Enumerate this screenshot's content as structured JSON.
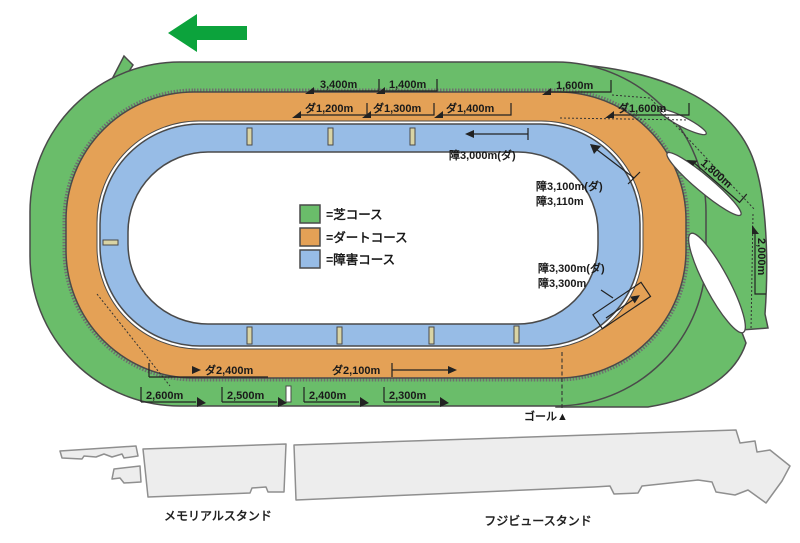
{
  "diagram": {
    "title": "racecourse-layout",
    "direction": "left",
    "colors": {
      "turf": "#6abd6a",
      "dirt": "#e4a156",
      "jump": "#97bce6",
      "direction_arrow": "#0ca33c",
      "stand_fill": "#ededed",
      "tick_fill": "#d9d4a5"
    },
    "legend": [
      {
        "label": "=芝コース",
        "color": "#6abd6a"
      },
      {
        "label": "=ダートコース",
        "color": "#e4a156"
      },
      {
        "label": "=障害コース",
        "color": "#97bce6"
      }
    ],
    "course_labels": {
      "turf_3400": "3,400m",
      "turf_1400": "1,400m",
      "turf_1600": "1,600m",
      "turf_1800": "1,800m",
      "turf_2000": "2,000m",
      "turf_2300": "2,300m",
      "turf_2400": "2,400m",
      "turf_2500": "2,500m",
      "turf_2600": "2,600m",
      "dirt_1200": "ダ1,200m",
      "dirt_1300": "ダ1,300m",
      "dirt_1400": "ダ1,400m",
      "dirt_1600": "ダ1,600m",
      "dirt_2100": "ダ2,100m",
      "dirt_2400": "ダ2,400m",
      "jump_3000": "障3,000m(ダ)",
      "jump_3100": "障3,100m(ダ)",
      "jump_3110": "障3,110m",
      "jump_3300_d": "障3,300m(ダ)",
      "jump_3300": "障3,300m",
      "goal": "ゴール▲"
    },
    "stands": {
      "memorial": "メモリアルスタンド",
      "fujiview": "フジビュースタンド"
    }
  }
}
